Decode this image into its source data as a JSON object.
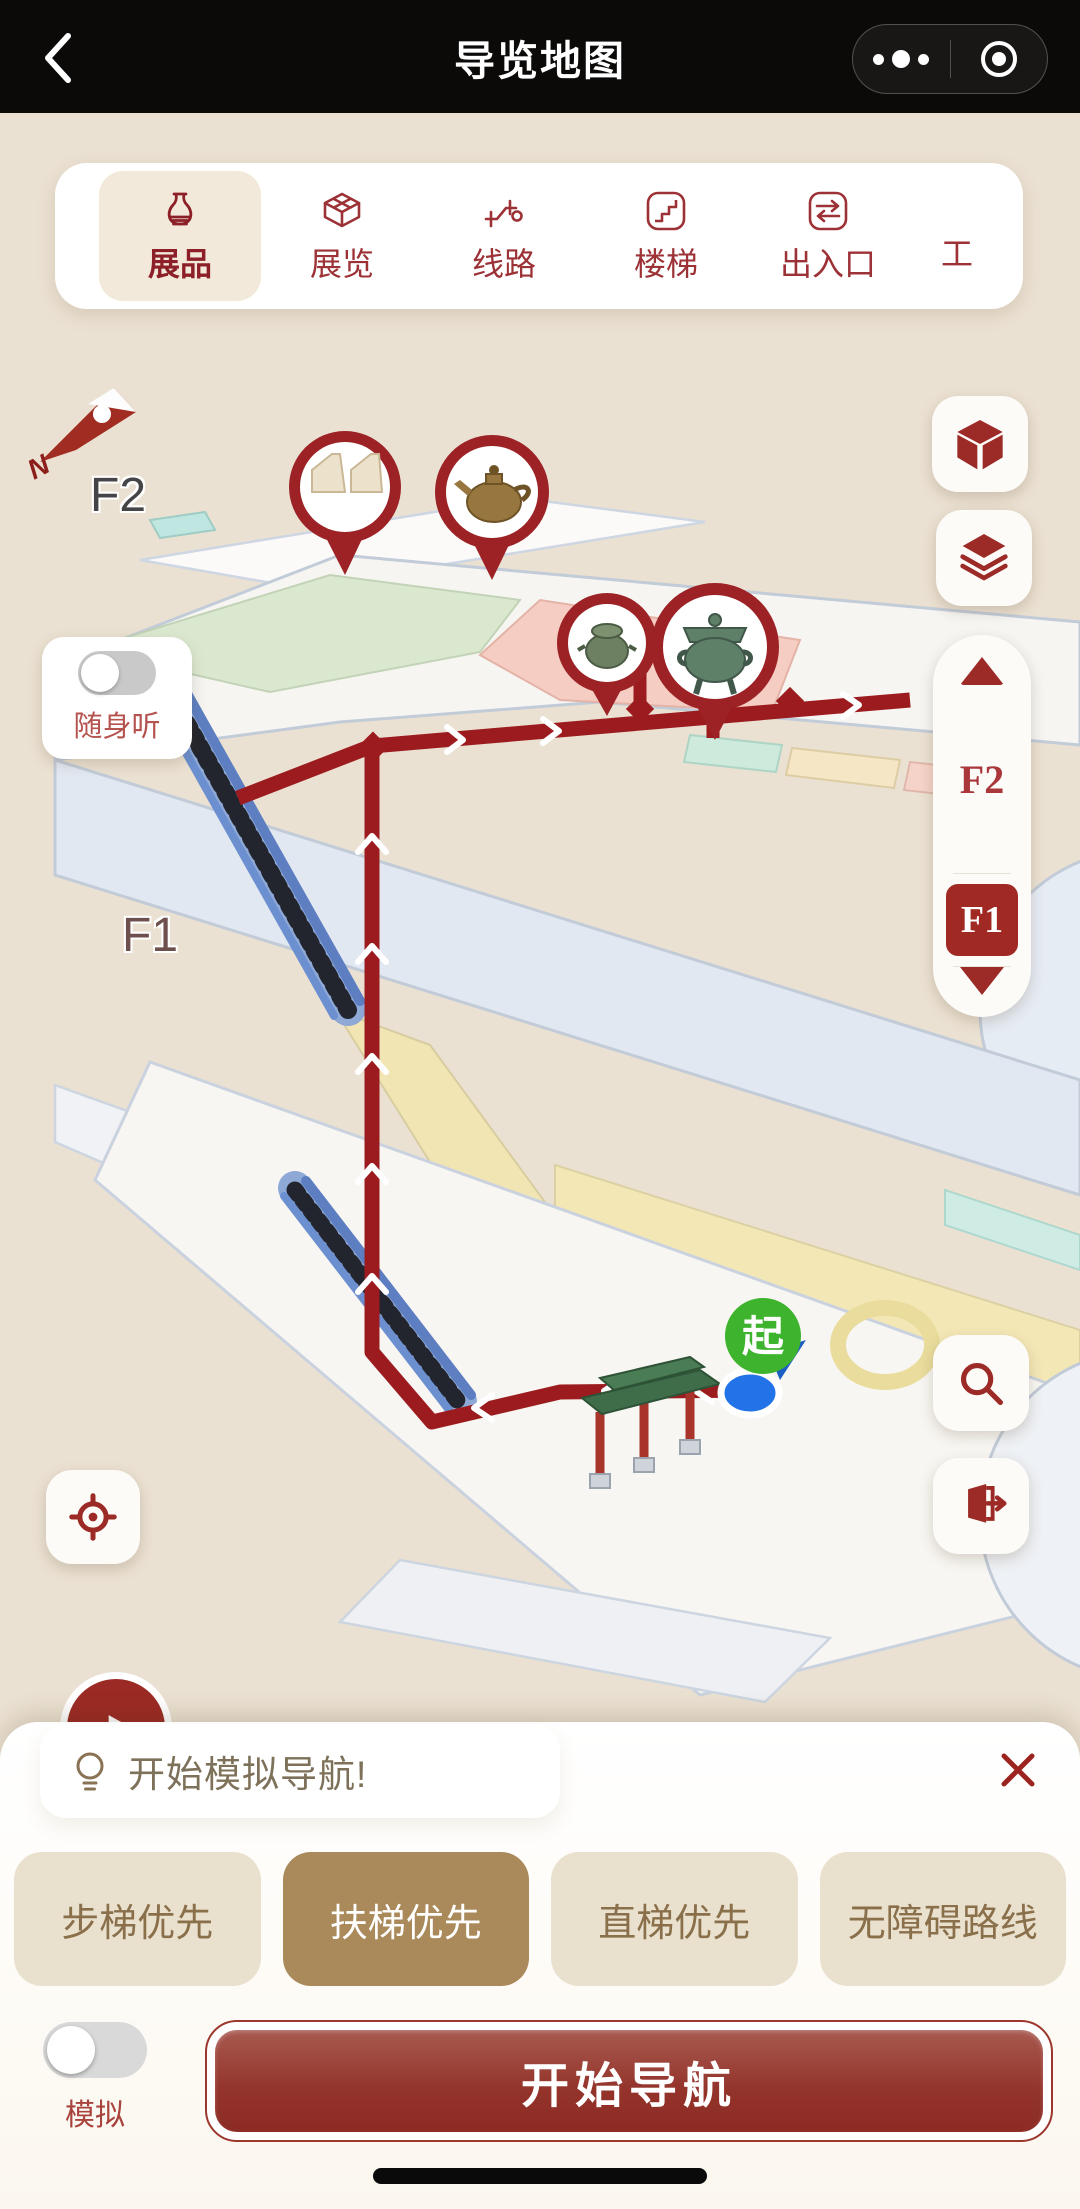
{
  "navbar": {
    "title": "导览地图"
  },
  "tabs": [
    {
      "label": "展品",
      "selected": true
    },
    {
      "label": "展览",
      "selected": false
    },
    {
      "label": "线路",
      "selected": false
    },
    {
      "label": "楼梯",
      "selected": false
    },
    {
      "label": "出入口",
      "selected": false
    },
    {
      "label": "工",
      "selected": false
    }
  ],
  "map": {
    "floor_label_f2": "F2",
    "floor_label_f1": "F1",
    "compass_north": "N",
    "audio_guide_label": "随身听",
    "start_marker_label": "起",
    "floor_selector": {
      "upper": "F2",
      "selected": "F1"
    }
  },
  "sheet": {
    "tip": "开始模拟导航!",
    "route_options": [
      {
        "label": "步梯优先",
        "selected": false
      },
      {
        "label": "扶梯优先",
        "selected": true
      },
      {
        "label": "直梯优先",
        "selected": false
      },
      {
        "label": "无障碍路线",
        "selected": false
      }
    ],
    "simulate_label": "模拟",
    "start_nav_label": "开始导航"
  },
  "colors": {
    "accent_red": "#9c2a26",
    "bg_beige": "#ebe1d2",
    "tab_selected_bg": "#f2e9da",
    "option_selected_bg": "#aa8a5b",
    "start_green": "#3db32e",
    "location_blue": "#1f6fd6"
  }
}
